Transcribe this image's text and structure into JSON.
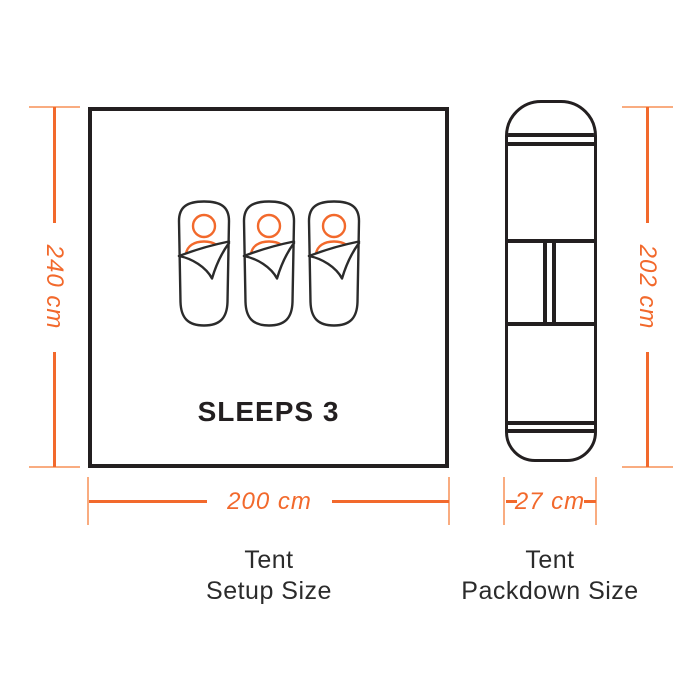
{
  "colors": {
    "accent": "#F2692C",
    "accent_light": "#F9AC80",
    "line_dark": "#231F20",
    "text_dark": "#2B2B2B",
    "background": "#FFFFFF"
  },
  "setup_diagram": {
    "sleeps_label": "SLEEPS 3",
    "height_label": "240 cm",
    "width_label": "200 cm",
    "caption_line1": "Tent",
    "caption_line2": "Setup Size",
    "sleeping_bag_count": 3,
    "icon": "sleeping-bag-icon"
  },
  "packdown_diagram": {
    "height_label": "202 cm",
    "width_label": "27 cm",
    "caption_line1": "Tent",
    "caption_line2": "Packdown Size"
  }
}
